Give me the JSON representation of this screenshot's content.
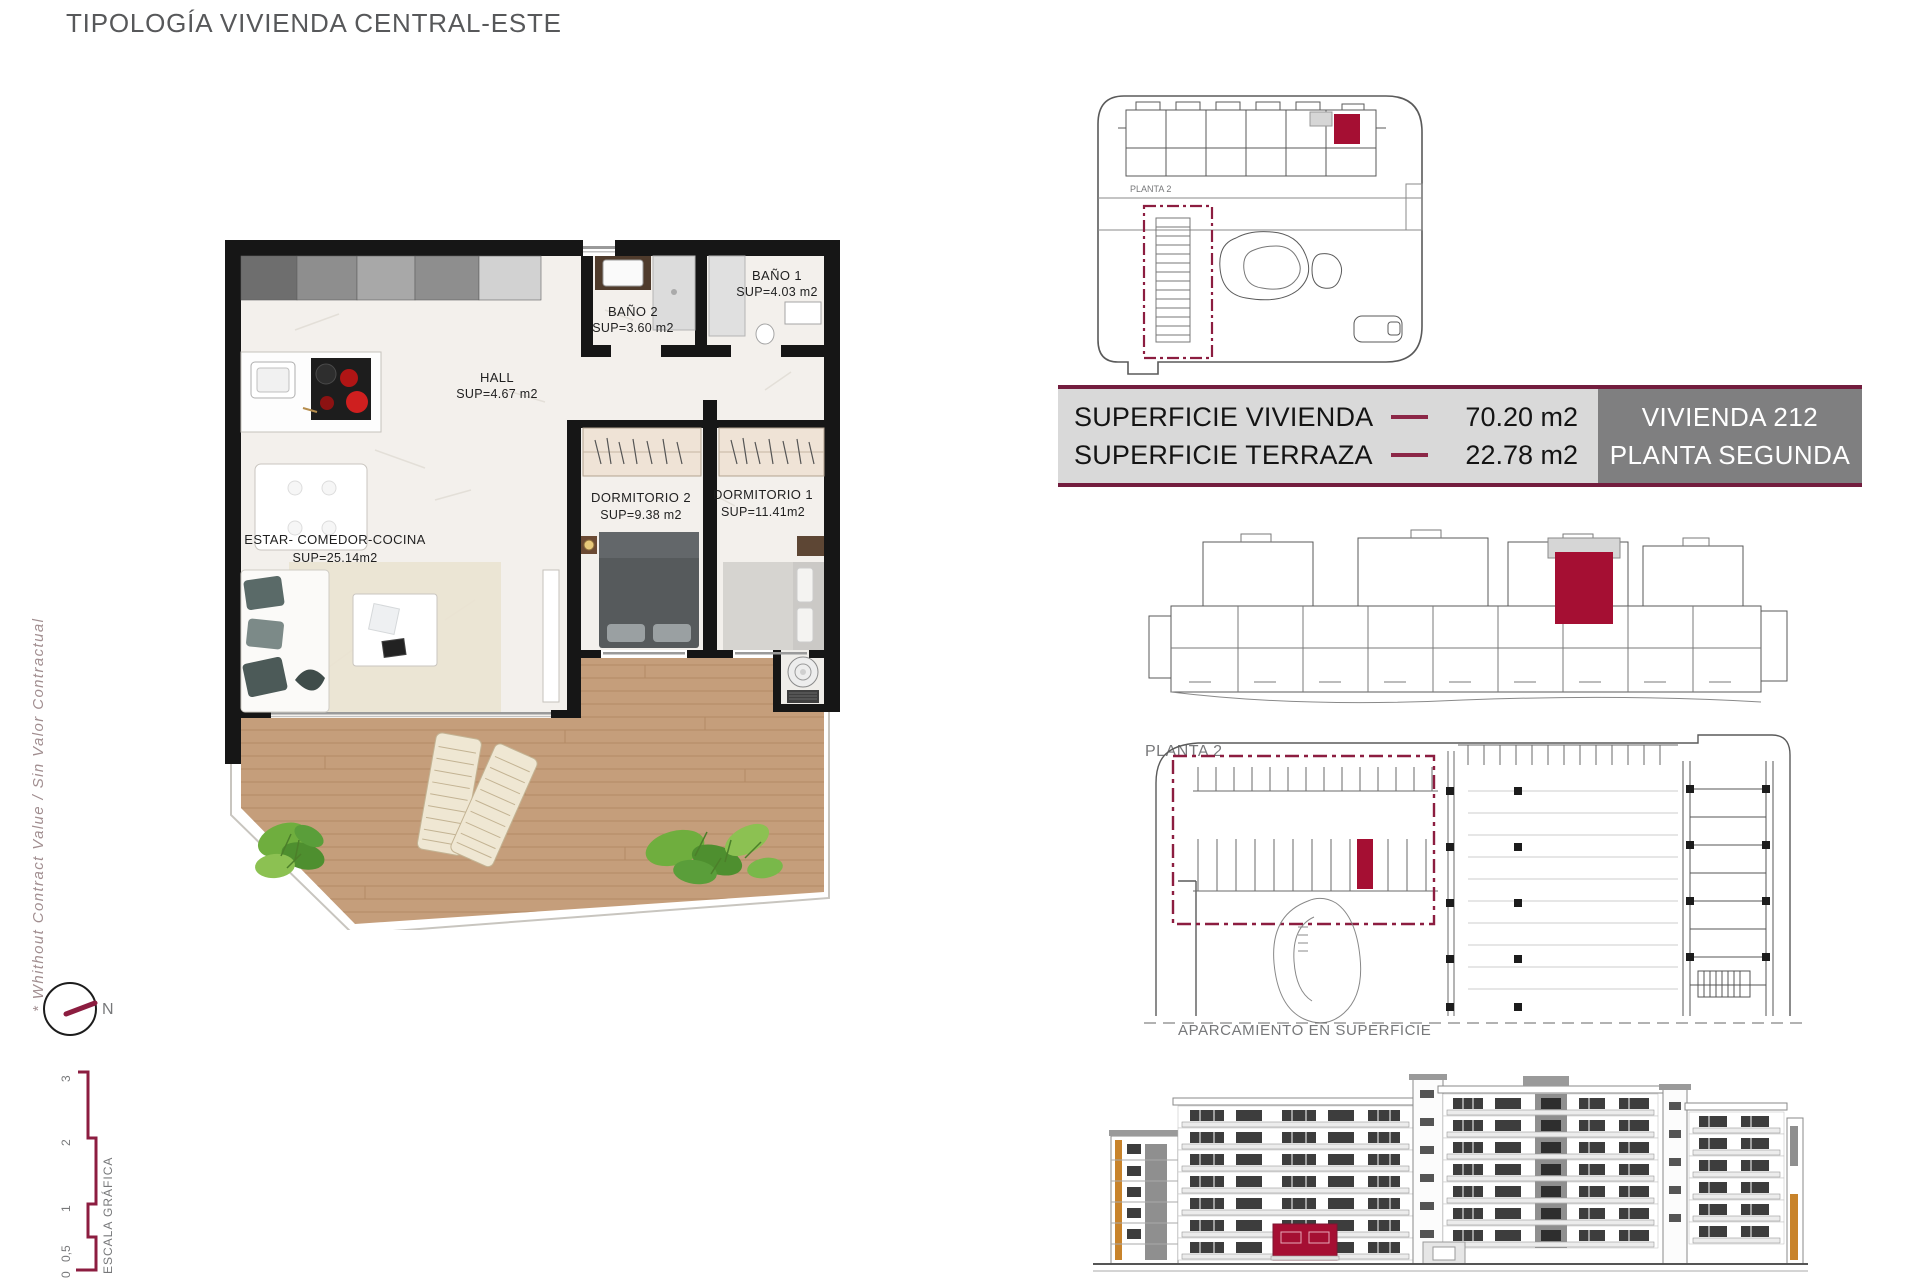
{
  "title": "TIPOLOGÍA VIVIENDA CENTRAL-ESTE",
  "side_note": "* Whithout Contract Value / Sin Valor Contractual",
  "compass": {
    "north_label": "N"
  },
  "scale_bar": {
    "label": "ESCALA GRÁFICA",
    "ticks": [
      "0",
      "0,5",
      "1",
      "2",
      "3"
    ]
  },
  "floor_plan": {
    "rooms": [
      {
        "name": "ESTAR- COMEDOR-COCINA",
        "area": "SUP=25.14m2"
      },
      {
        "name": "HALL",
        "area": "SUP=4.67 m2"
      },
      {
        "name": "BAÑO 2",
        "area": "SUP=3.60 m2"
      },
      {
        "name": "BAÑO 1",
        "area": "SUP=4.03 m2"
      },
      {
        "name": "DORMITORIO 1",
        "area": "SUP=11.41m2"
      },
      {
        "name": "DORMITORIO 2",
        "area": "SUP=9.38 m2"
      }
    ]
  },
  "summary": {
    "rows": [
      {
        "label": "SUPERFICIE VIVIENDA",
        "value": "70.20 m2"
      },
      {
        "label": "SUPERFICIE TERRAZA",
        "value": "22.78 m2"
      }
    ],
    "unit": {
      "name": "VIVIENDA 212",
      "floor": "PLANTA SEGUNDA"
    }
  },
  "plans": {
    "site_plan_label": "PLANTA 2",
    "floor_plate_label": "PLANTA 2",
    "parking_label": "APARCAMIENTO EN SUPERFICIE"
  },
  "colors": {
    "accent_red": "#a50f33",
    "maroon": "#8c1d40",
    "table_bg": "#d9d9d9",
    "unit_box_bg": "#7f7f80",
    "text_gray": "#58595b",
    "wood": "#c59e7b"
  }
}
